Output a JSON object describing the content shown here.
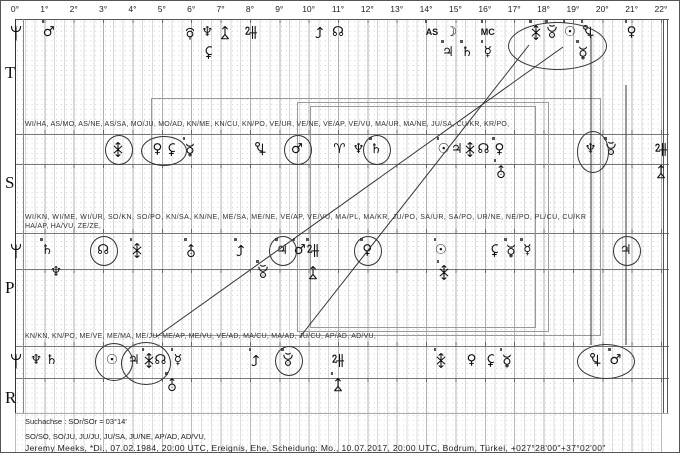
{
  "header": {
    "degree_labels": [
      "0°",
      "1°",
      "2°",
      "3°",
      "4°",
      "5°",
      "6°",
      "7°",
      "8°",
      "9°",
      "10°",
      "11°",
      "12°",
      "13°",
      "14°",
      "15°",
      "16°",
      "17°",
      "18°",
      "19°",
      "20°",
      "21°",
      "22°"
    ]
  },
  "sectors": [
    "T",
    "S",
    "P",
    "R"
  ],
  "rows": {
    "row1_label": "WI/HA, AS/MO, AS/NE, AS/SA, MO/JU, MO/AD, KN/ME, KN/CU, KN/PO, VE/UR, VE/NE, VE/AP, VE/VU, MA/UR, MA/NE, JU/SA, CU/KR, KR/PO,",
    "row2_label_line1": "WI/KN, WI/ME, WI/UR, SO/KN, SO/PO, KN/SA, KN/NE, ME/SA, ME/NE, VE/AP, VE/VU, MA/PL, MA/KR, JU/PO, SA/UR, SA/PO, UR/NE, NE/PO, PL/CU, CU/KR",
    "row2_label_line2": "HA/AP, HA/VU, ZE/ZE,",
    "row3_label": "KN/KN, KN/PO, ME/VE, ME/MA, ME/JU, ME/AP, ME/VU, VE/AD, MA/CU, MA/AD, JU/CU, AP/AD, AD/VU,"
  },
  "glyph_rows": {
    "top": [
      {
        "d": 0.02,
        "s": "wi"
      },
      {
        "d": 1.15,
        "s": "mars",
        "t": 1
      },
      {
        "d": 5.95,
        "s": "plutoA"
      },
      {
        "d": 6.55,
        "s": "neptune"
      },
      {
        "d": 6.6,
        "s": "hades",
        "b": 1
      },
      {
        "d": 7.15,
        "s": "zeus"
      },
      {
        "d": 8.05,
        "s": "apollon"
      },
      {
        "d": 10.4,
        "s": "kronos"
      },
      {
        "d": 11.0,
        "s": "node"
      },
      {
        "d": 14.2,
        "s": "as",
        "t": 1
      },
      {
        "d": 14.85,
        "s": "moon"
      },
      {
        "d": 14.75,
        "s": "jupiter",
        "b": 1,
        "t": 1
      },
      {
        "d": 15.4,
        "s": "saturn",
        "b": 1,
        "t": 1
      },
      {
        "d": 16.1,
        "s": "mc",
        "t": 1
      },
      {
        "d": 16.1,
        "s": "mercury",
        "b": 1,
        "t": 1
      },
      {
        "d": 17.75,
        "s": "vulkX",
        "t": 1
      },
      {
        "d": 18.3,
        "s": "poseidonC",
        "t": 1
      },
      {
        "d": 18.9,
        "s": "sun",
        "t": 1
      },
      {
        "d": 19.5,
        "s": "cupido",
        "t": 1
      },
      {
        "d": 19.35,
        "s": "admetos",
        "b": 1,
        "t": 1
      },
      {
        "d": 21.0,
        "s": "venus",
        "t": 1
      }
    ],
    "t": [
      {
        "d": 3.5,
        "s": "vulkX",
        "c": 1
      },
      {
        "d": 4.85,
        "s": "venus"
      },
      {
        "d": 5.35,
        "s": "hades"
      },
      {
        "d": 5.95,
        "s": "admetos",
        "t": 1
      },
      {
        "d": 8.35,
        "s": "cupido"
      },
      {
        "d": 9.6,
        "s": "mars",
        "c": 1
      },
      {
        "d": 11.05,
        "s": "aries"
      },
      {
        "d": 11.7,
        "s": "neptune"
      },
      {
        "d": 12.3,
        "s": "saturn",
        "c": 1,
        "t": 1
      },
      {
        "d": 14.6,
        "s": "sun",
        "t": 1
      },
      {
        "d": 15.05,
        "s": "jupiter"
      },
      {
        "d": 15.5,
        "s": "vulkX"
      },
      {
        "d": 15.95,
        "s": "node"
      },
      {
        "d": 16.5,
        "s": "venus",
        "t": 1
      },
      {
        "d": 16.55,
        "s": "uranusA",
        "b": 1,
        "t": 1
      },
      {
        "d": 19.6,
        "s": "neptune"
      },
      {
        "d": 20.3,
        "s": "poseidonC",
        "t": 1
      },
      {
        "d": 22.0,
        "s": "apollon"
      },
      {
        "d": 22.0,
        "s": "zeus",
        "b": 1
      }
    ],
    "p": [
      {
        "d": 0.02,
        "s": "wi"
      },
      {
        "d": 1.1,
        "s": "saturn",
        "t": 1
      },
      {
        "d": 1.4,
        "s": "neptune",
        "b": 1
      },
      {
        "d": 3.0,
        "s": "node",
        "c": 1
      },
      {
        "d": 4.15,
        "s": "vulkX",
        "t": 1
      },
      {
        "d": 6.0,
        "s": "uranusA",
        "t": 1
      },
      {
        "d": 7.7,
        "s": "kronos",
        "t": 1
      },
      {
        "d": 8.45,
        "s": "poseidonC",
        "b": 1,
        "t": 1
      },
      {
        "d": 9.1,
        "s": "jupiter",
        "c": 1,
        "t": 1
      },
      {
        "d": 9.7,
        "s": "mars",
        "t": 1
      },
      {
        "d": 10.15,
        "s": "apollon",
        "t": 1
      },
      {
        "d": 10.15,
        "s": "zeus",
        "b": 1
      },
      {
        "d": 12.0,
        "s": "venus",
        "c": 1,
        "t": 1
      },
      {
        "d": 14.5,
        "s": "sun",
        "t": 1
      },
      {
        "d": 14.6,
        "s": "vulkX",
        "b": 1,
        "t": 1
      },
      {
        "d": 16.35,
        "s": "hades"
      },
      {
        "d": 16.9,
        "s": "admetos",
        "t": 1
      },
      {
        "d": 17.45,
        "s": "mercury",
        "t": 1
      },
      {
        "d": 20.8,
        "s": "jupiter",
        "c": 1
      }
    ],
    "r": [
      {
        "d": 0.02,
        "s": "wi"
      },
      {
        "d": 0.72,
        "s": "neptune"
      },
      {
        "d": 1.25,
        "s": "saturn"
      },
      {
        "d": 3.3,
        "s": "sun"
      },
      {
        "d": 4.05,
        "s": "jupiter"
      },
      {
        "d": 4.55,
        "s": "vulkX",
        "t": 1
      },
      {
        "d": 4.95,
        "s": "node"
      },
      {
        "d": 5.55,
        "s": "mercury",
        "t": 1
      },
      {
        "d": 5.35,
        "s": "uranusA",
        "b": 1,
        "t": 1
      },
      {
        "d": 8.2,
        "s": "kronos",
        "t": 1
      },
      {
        "d": 9.3,
        "s": "poseidonC",
        "c": 1,
        "t": 1
      },
      {
        "d": 11.0,
        "s": "apollon"
      },
      {
        "d": 11.0,
        "s": "zeus",
        "b": 1,
        "t": 1
      },
      {
        "d": 14.5,
        "s": "vulkX",
        "t": 1
      },
      {
        "d": 15.55,
        "s": "venus"
      },
      {
        "d": 16.2,
        "s": "hades"
      },
      {
        "d": 16.75,
        "s": "admetos",
        "t": 1
      },
      {
        "d": 19.75,
        "s": "cupido"
      },
      {
        "d": 20.45,
        "s": "mars",
        "t": 1
      }
    ]
  },
  "ellipses": [
    {
      "x": 507,
      "y": 21,
      "w": 97,
      "h": 46
    },
    {
      "x": 140,
      "y": 135,
      "w": 44,
      "h": 28
    },
    {
      "x": 576,
      "y": 130,
      "w": 30,
      "h": 40
    },
    {
      "x": 94,
      "y": 342,
      "w": 36,
      "h": 36
    },
    {
      "x": 120,
      "y": 341,
      "w": 48,
      "h": 41
    },
    {
      "x": 576,
      "y": 343,
      "w": 56,
      "h": 33
    }
  ],
  "lines": [
    {
      "x1": 528,
      "y1": 44,
      "x2": 299,
      "y2": 336
    },
    {
      "x1": 562,
      "y1": 46,
      "x2": 155,
      "y2": 336
    },
    {
      "x1": 590,
      "y1": 34,
      "x2": 590,
      "y2": 344
    },
    {
      "x1": 625,
      "y1": 84,
      "x2": 625,
      "y2": 344
    }
  ],
  "boxes": [
    {
      "x": 150,
      "y": 97,
      "w": 448,
      "h": 236
    },
    {
      "x": 296,
      "y": 101,
      "w": 250,
      "h": 228
    },
    {
      "x": 309,
      "y": 105,
      "w": 224,
      "h": 220
    }
  ],
  "footer": {
    "search_axis": "Suchachse : SOr/SOr = 03°14'",
    "axis_list": "SO/SO, SO/JU, JU/JU, JU/SA, JU/NE, AP/AD, AD/VU,",
    "event_line": "Jeremy Meeks, *Di., 07.02.1984, 20:00 UTC, Ereignis, Ehe, Scheidung: Mo., 10.07.2017, 20:00 UTC, Bodrum, Türkei, +027°28'00\"+37°02'00\""
  }
}
